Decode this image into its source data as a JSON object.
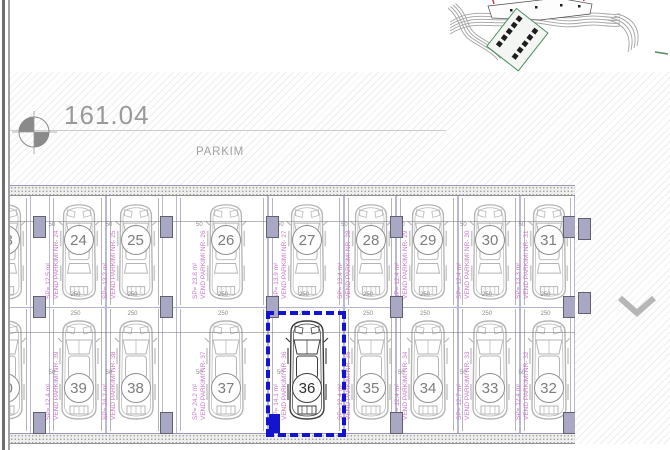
{
  "title_block": {
    "elevation": "161.04",
    "area_label": "PARKIM"
  },
  "selection": {
    "selected_stall": "36"
  },
  "stalls": {
    "dim_width": "250",
    "dim_offset": "50",
    "top_row": [
      {
        "num": "23",
        "sp_label": "SP= 13.6 m²",
        "nr_label": "VEND PARKIMI NR- 23"
      },
      {
        "num": "24",
        "sp_label": "SP= 12.5 m²",
        "nr_label": "VEND PARKIMI NR- 24"
      },
      {
        "num": "25",
        "sp_label": "SP= 13.2 m²",
        "nr_label": "VEND PARKIMI NR- 25"
      },
      {
        "num": "26",
        "sp_label": "SP= 23.8 m²",
        "nr_label": "VEND PARKIMI NR- 26"
      },
      {
        "num": "27",
        "sp_label": "SP= 13.9 m²",
        "nr_label": "VEND PARKIMI NR- 27"
      },
      {
        "num": "28",
        "sp_label": "SP= 13.4 m²",
        "nr_label": "VEND PARKIMI NR- 28"
      },
      {
        "num": "29",
        "sp_label": "SP= 12.4 m²",
        "nr_label": "VEND PARKIMI NR- 29"
      },
      {
        "num": "30",
        "sp_label": "SP= 12.4 m²",
        "nr_label": "VEND PARKIMI NR- 30"
      },
      {
        "num": "31",
        "sp_label": "SP= 13.3 m²",
        "nr_label": "VEND PARKIMI NR- 31"
      }
    ],
    "bottom_row": [
      {
        "num": "40",
        "sp_label": "SP= 12.4 m²",
        "nr_label": "VEND PARKIMI NR- 40"
      },
      {
        "num": "39",
        "sp_label": "SP= 12.4 m²",
        "nr_label": "VEND PARKIMI NR- 39"
      },
      {
        "num": "38",
        "sp_label": "SP= 24.2 m²",
        "nr_label": "VEND PARKIMI NR- 38"
      },
      {
        "num": "37",
        "sp_label": "SP= 24.2 m²",
        "nr_label": "VEND PARKIMI NR- 37"
      },
      {
        "num": "36",
        "sp_label": "SP= 14.1 m²",
        "nr_label": "VEND PARKIMI NR- 36"
      },
      {
        "num": "35",
        "sp_label": "SP= 12.4 m²",
        "nr_label": "VEND PARKIMI NR- 35"
      },
      {
        "num": "34",
        "sp_label": "SP= 12.4 m²",
        "nr_label": "VEND PARKIMI NR- 34"
      },
      {
        "num": "33",
        "sp_label": "SP= 12.7 m²",
        "nr_label": "VEND PARKIMI NR- 33"
      },
      {
        "num": "32",
        "sp_label": "SP= 12.4 m²",
        "nr_label": "VEND PARKIMI NR- 32"
      }
    ]
  },
  "colors": {
    "selection_blue": "#1414cf",
    "stall_line": "#b9b9da",
    "car_gray": "#b5b5b5",
    "selected_car": "#3d3d3d",
    "label_magenta": "#c877c8",
    "column_fill": "#a8a8c5",
    "site_green": "#4e8f5e",
    "site_red": "#c0392b"
  }
}
